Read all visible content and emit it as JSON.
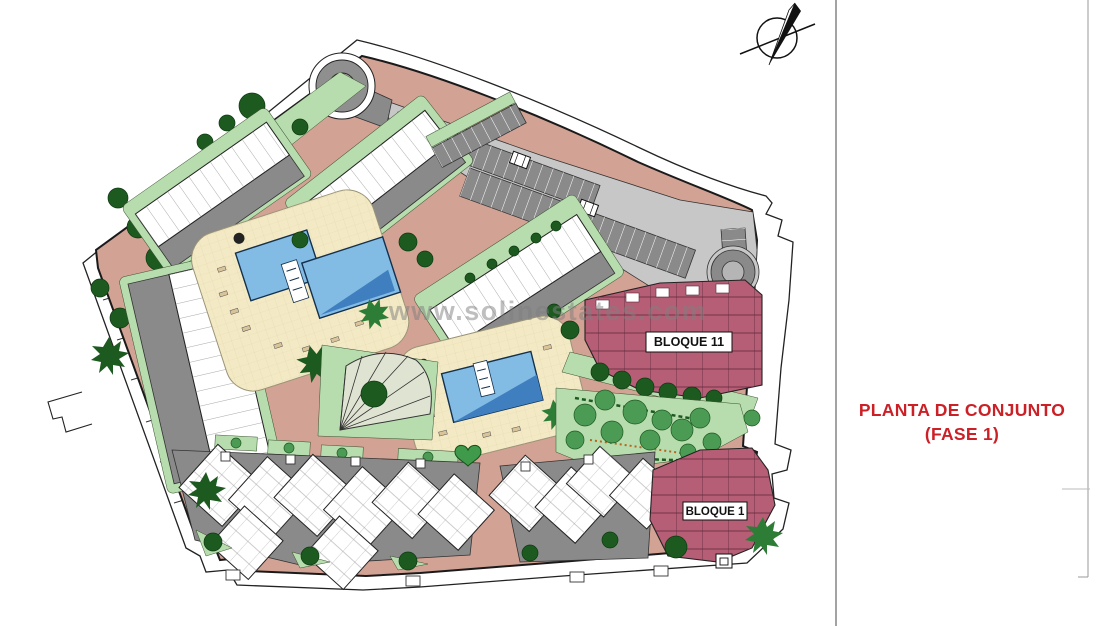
{
  "title": {
    "line1": "PLANTA DE CONJUNTO",
    "line2": "(FASE 1)"
  },
  "watermark": {
    "text": "www.solinestates.com"
  },
  "labels": {
    "bloque11": "BLOQUE 11",
    "bloque1": "BLOQUE 1"
  },
  "colors": {
    "path_salmon": "#d2a294",
    "lawn_green": "#b7dcae",
    "tree_dark": "#1d5a20",
    "tree_mid": "#4c9b55",
    "parking_gray": "#8a8a8a",
    "parking_light": "#c7c7c7",
    "deck_cream": "#f3e9c4",
    "pool_blue": "#82bbe3",
    "pool_deep": "#3f7fc0",
    "block_maroon": "#b55e76",
    "building_white": "#ffffff",
    "outline": "#1a1a1a",
    "title_red": "#cc2027",
    "watermark_gray": "#808080"
  },
  "icons": {
    "north-arrow": "compass needle through circle",
    "tree": "filled circle",
    "palm-tree": "spiky star",
    "car": "outlined rectangle",
    "roundabout": "concentric circles",
    "heart-lawn": "heart shape",
    "utility-box": "nested squares"
  }
}
